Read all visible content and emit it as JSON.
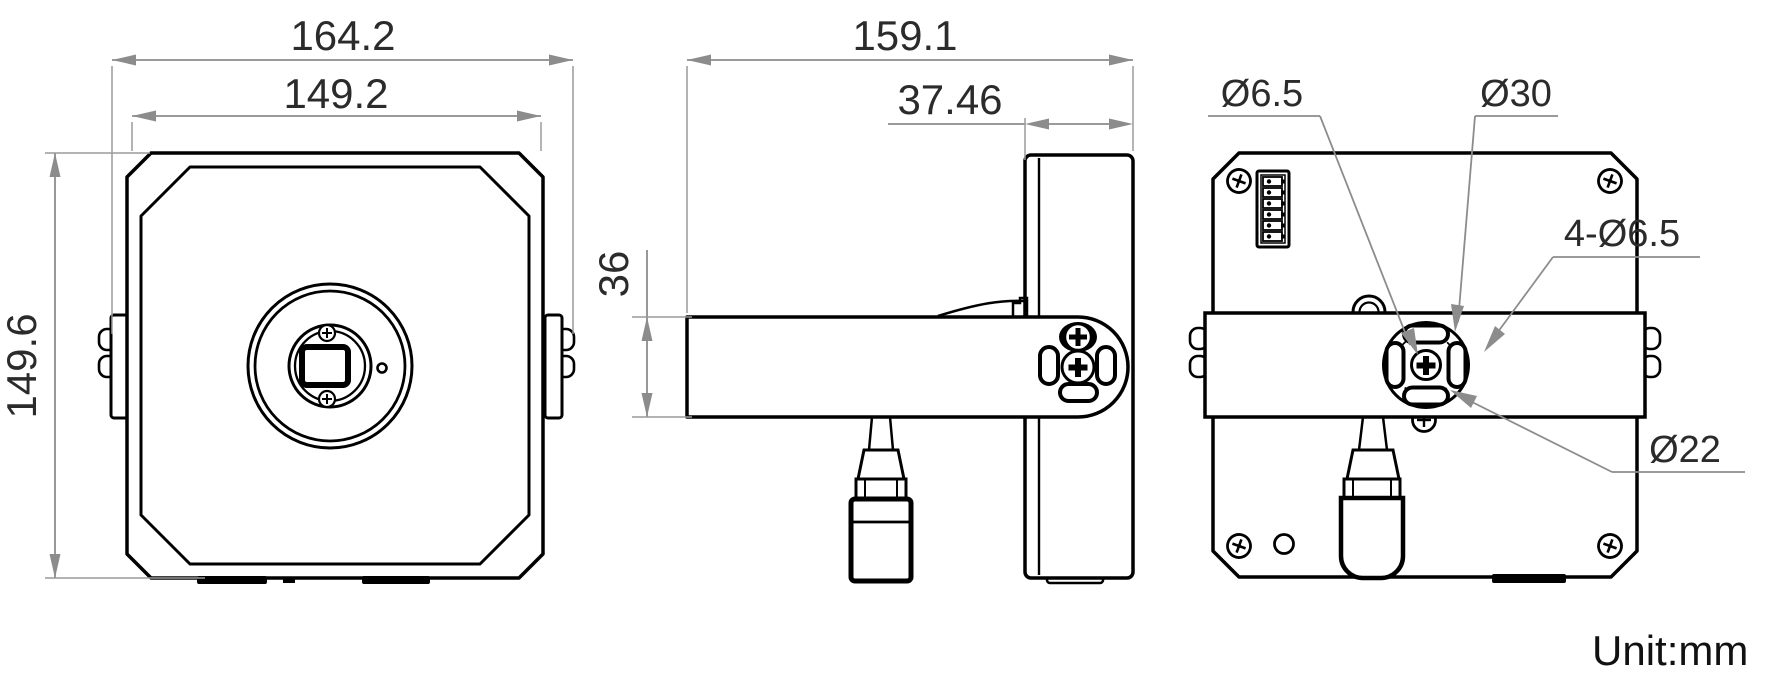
{
  "dimensions": {
    "front": {
      "total_width": "164.2",
      "body_width": "149.2",
      "body_height": "149.6"
    },
    "side": {
      "total_depth": "159.1",
      "body_depth": "37.46",
      "bracket_height": "36"
    },
    "rear": {
      "center_screw": "Ø6.5",
      "mount_circle": "Ø30",
      "mount_slots": "4-Ø6.5",
      "slot_pitch_circle": "Ø22"
    }
  },
  "unit_note": "Unit:mm",
  "colors": {
    "part_line": "#000000",
    "dimension_line": "#8c8c8c",
    "text": "#2b2b2b"
  }
}
